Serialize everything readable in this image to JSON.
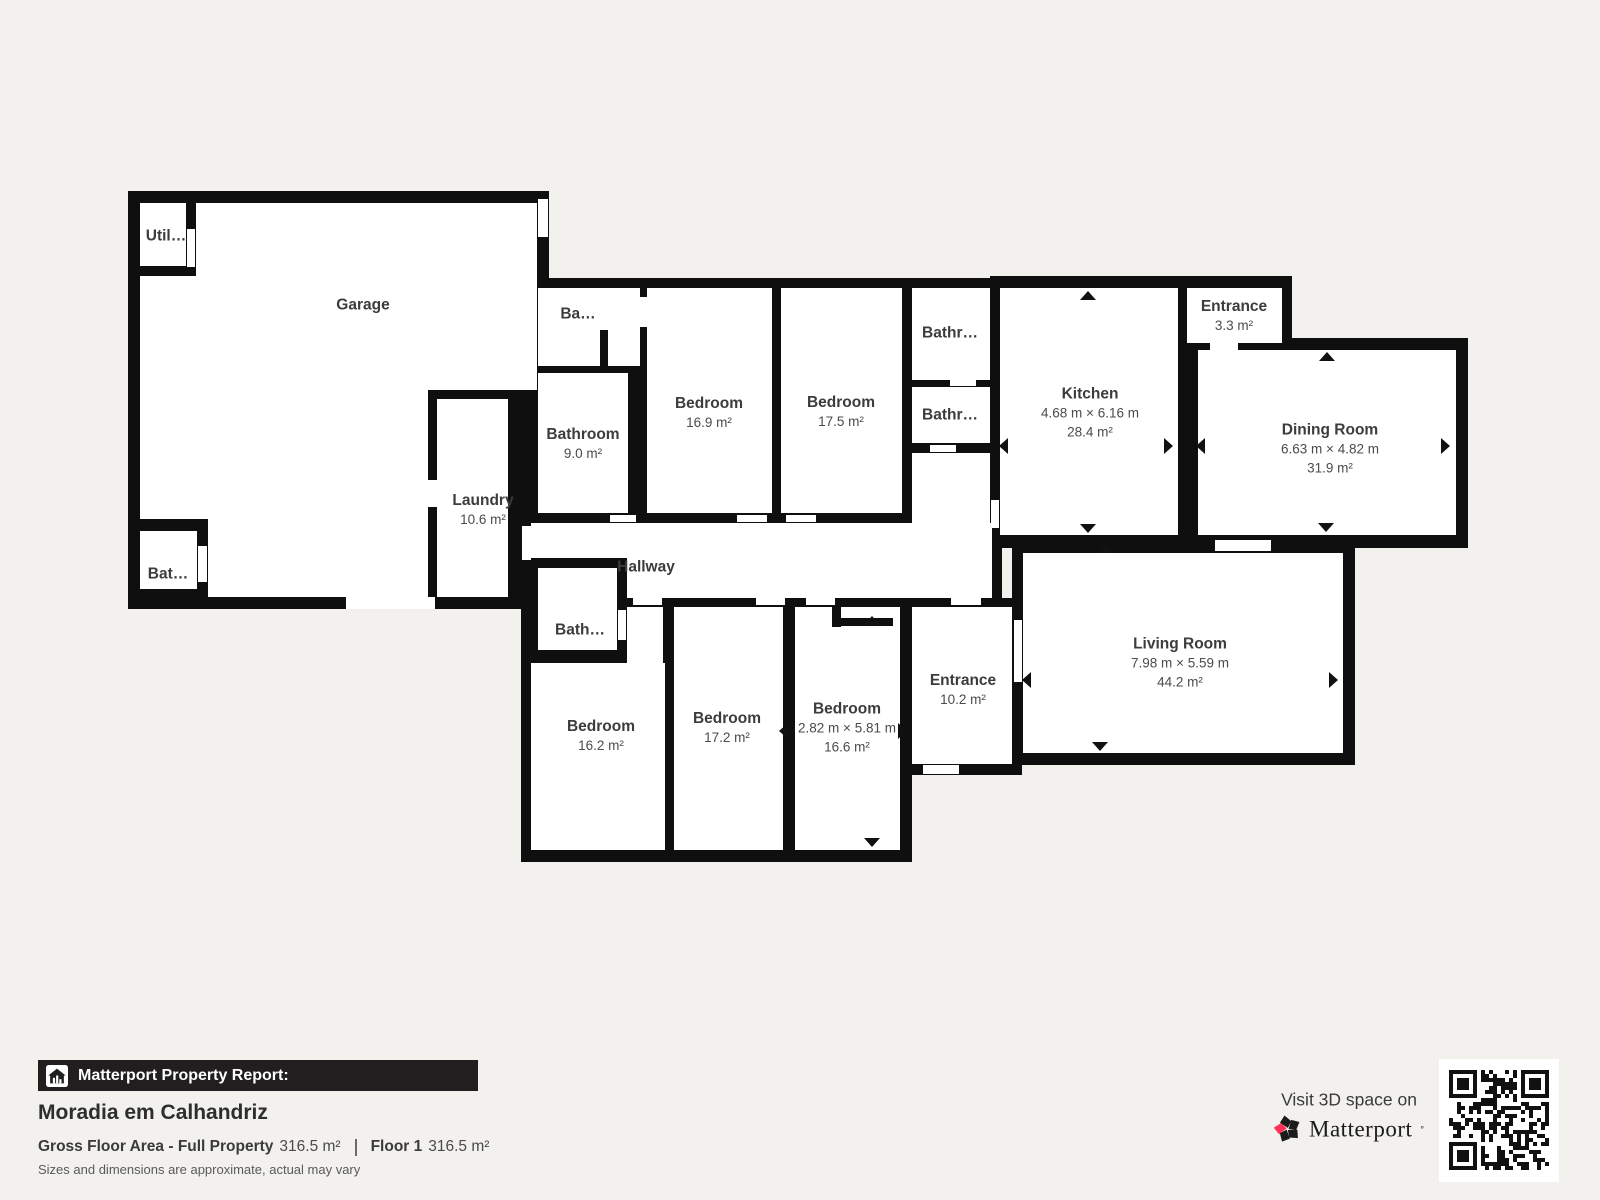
{
  "plan": {
    "rooms": {
      "garage": {
        "name": "Garage"
      },
      "utility": {
        "name": "Util…"
      },
      "bathroom_garage": {
        "name": "Bat…"
      },
      "laundry": {
        "name": "Laundry",
        "area": "10.6 m²"
      },
      "bathroom_small_top": {
        "name": "Ba…"
      },
      "bathroom_main": {
        "name": "Bathroom",
        "area": "9.0 m²"
      },
      "bedroom_169": {
        "name": "Bedroom",
        "area": "16.9 m²"
      },
      "bedroom_175": {
        "name": "Bedroom",
        "area": "17.5 m²"
      },
      "bathroom_top": {
        "name": "Bathr…"
      },
      "bathroom_bottom": {
        "name": "Bathr…"
      },
      "kitchen": {
        "name": "Kitchen",
        "dims": "4.68 m × 6.16 m",
        "area": "28.4 m²"
      },
      "entrance_top": {
        "name": "Entrance",
        "area": "3.3 m²"
      },
      "dining": {
        "name": "Dining Room",
        "dims": "6.63 m × 4.82 m",
        "area": "31.9 m²"
      },
      "hallway": {
        "name": "Hallway"
      },
      "bathroom_hall": {
        "name": "Bath…"
      },
      "bedroom_162": {
        "name": "Bedroom",
        "area": "16.2 m²"
      },
      "bedroom_172": {
        "name": "Bedroom",
        "area": "17.2 m²"
      },
      "bedroom_166": {
        "name": "Bedroom",
        "dims": "2.82 m × 5.81 m",
        "area": "16.6 m²"
      },
      "entrance_main": {
        "name": "Entrance",
        "area": "10.2 m²"
      },
      "living": {
        "name": "Living Room",
        "dims": "7.98 m × 5.59 m",
        "area": "44.2 m²"
      }
    }
  },
  "footer": {
    "report_label": "Matterport Property Report:",
    "property_name": "Moradia em Calhandriz",
    "gross_label": "Gross Floor Area - Full Property",
    "gross_value": "316.5 m²",
    "floor_label": "Floor 1",
    "floor_value": "316.5 m²",
    "disclaimer": "Sizes and dimensions are approximate, actual may vary"
  },
  "branding": {
    "visit_text": "Visit 3D space on",
    "brand_name": "Matterport",
    "icons": [
      "house-report-icon",
      "matterport-pinwheel-icon",
      "qr-code",
      "door-direction-arrow-icon"
    ]
  },
  "colors": {
    "wall": "#0f0f0f",
    "floor": "#ffffff",
    "background": "#f2f1ee",
    "accent_pink": "#ff3158",
    "report_bar_bg": "#201e1e"
  }
}
